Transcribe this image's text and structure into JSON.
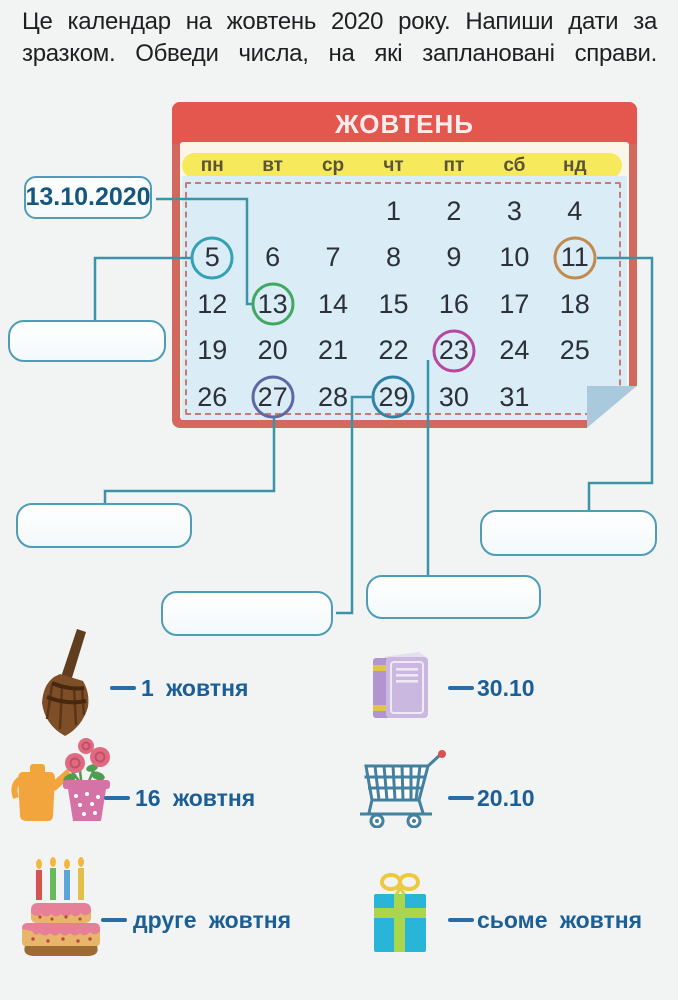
{
  "instructions": "Це календар на жовтень 2020 року. Напиши дати за зразком. Обведи числа, на які заплановані справи.",
  "calendar": {
    "title": "ЖОВТЕНЬ",
    "weekdays": [
      "пн",
      "вт",
      "ср",
      "чт",
      "пт",
      "сб",
      "нд"
    ],
    "weeks": [
      [
        "",
        "",
        "",
        "1",
        "2",
        "3",
        "4"
      ],
      [
        "5",
        "6",
        "7",
        "8",
        "9",
        "10",
        "11"
      ],
      [
        "12",
        "13",
        "14",
        "15",
        "16",
        "17",
        "18"
      ],
      [
        "19",
        "20",
        "21",
        "22",
        "23",
        "24",
        "25"
      ],
      [
        "26",
        "27",
        "28",
        "29",
        "30",
        "31",
        ""
      ]
    ],
    "circled_days": [
      {
        "day": "5",
        "color": "#35a1b5"
      },
      {
        "day": "11",
        "color": "#c28a4c"
      },
      {
        "day": "13",
        "color": "#41a863"
      },
      {
        "day": "23",
        "color": "#b8479f"
      },
      {
        "day": "27",
        "color": "#5e68a5"
      },
      {
        "day": "29",
        "color": "#2f83a8"
      }
    ]
  },
  "example_box": {
    "value": "13.10.2020"
  },
  "answer_boxes": [
    {
      "id": "box-5",
      "for_day": "5",
      "value": ""
    },
    {
      "id": "box-27",
      "for_day": "27",
      "value": ""
    },
    {
      "id": "box-29",
      "for_day": "29",
      "value": ""
    },
    {
      "id": "box-23",
      "for_day": "23",
      "value": ""
    },
    {
      "id": "box-11",
      "for_day": "11",
      "value": ""
    }
  ],
  "legend": {
    "items": [
      {
        "icon": "broom-icon",
        "label": "1 жовтня"
      },
      {
        "icon": "book-icon",
        "label": "30.10"
      },
      {
        "icon": "flowers-icon",
        "label": "16 жовтня"
      },
      {
        "icon": "cart-icon",
        "label": "20.10"
      },
      {
        "icon": "cake-icon",
        "label": "друге жовтня"
      },
      {
        "icon": "gift-icon",
        "label": "сьоме жовтня"
      }
    ]
  },
  "colors": {
    "header_red": "#e4574f",
    "frame_red": "#d2685e",
    "weekday_band_yellow": "#f6e95c",
    "calendar_blue": "#daecf6",
    "dashed_border": "#cb7a72",
    "connector_teal": "#3a93a8",
    "box_border": "#4e9db5",
    "label_blue": "#1b5f96",
    "date_text": "#2c3038"
  }
}
